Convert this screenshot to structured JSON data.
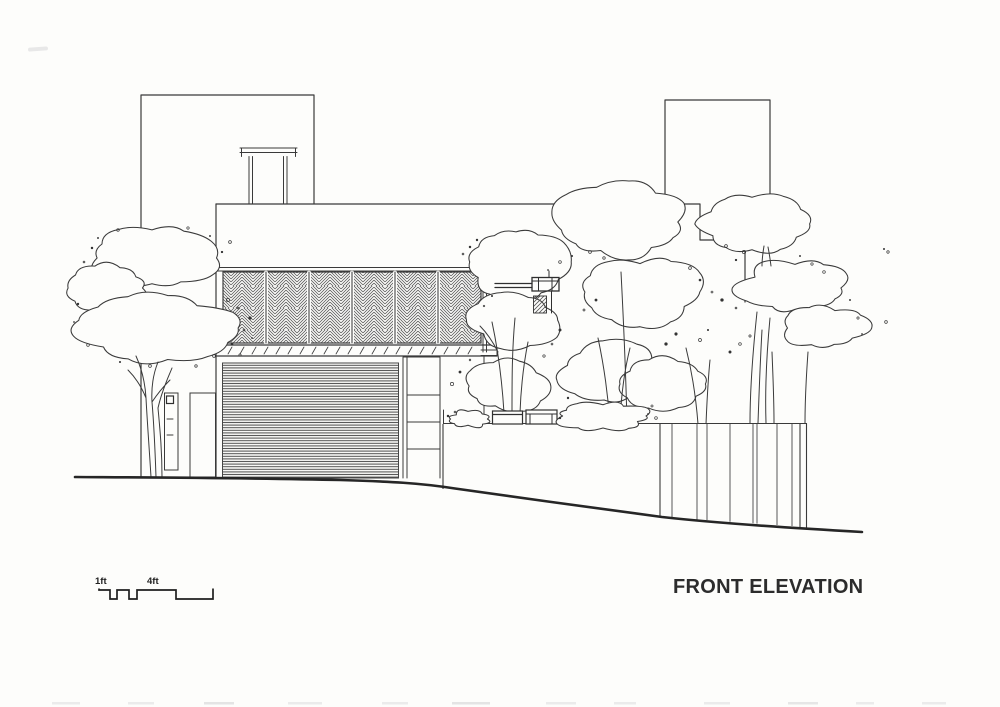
{
  "drawing": {
    "title": "FRONT ELEVATION",
    "scale_bar": {
      "label_small": "1ft",
      "label_large": "4ft"
    },
    "colors": {
      "paper": "#fdfdfb",
      "ink": "#3a3a3a",
      "ink_dark": "#262626",
      "hatch_gray": "#4e4e4e",
      "screen_hatch": "#5c5c5c"
    }
  }
}
